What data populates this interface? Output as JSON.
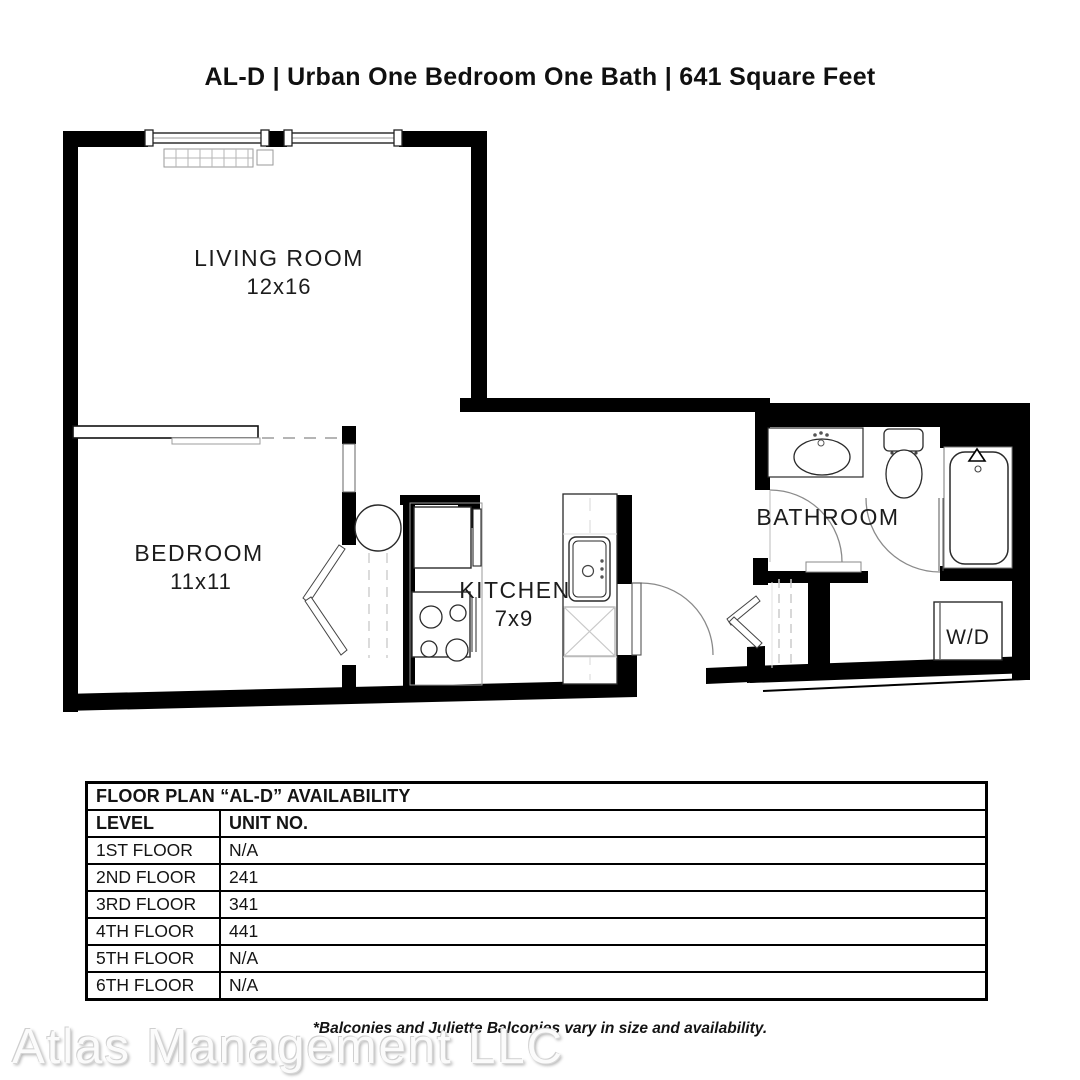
{
  "title": "AL-D | Urban One Bedroom One Bath | 641 Square Feet",
  "floor_plan": {
    "rooms": [
      {
        "name": "LIVING ROOM",
        "dimensions": "12x16"
      },
      {
        "name": "BEDROOM",
        "dimensions": "11x11"
      },
      {
        "name": "KITCHEN",
        "dimensions": "7x9"
      },
      {
        "name": "BATHROOM",
        "dimensions": ""
      },
      {
        "name": "W/D",
        "dimensions": ""
      }
    ]
  },
  "availability_table": {
    "title": "FLOOR PLAN “AL-D” AVAILABILITY",
    "columns": {
      "level": "LEVEL",
      "unit": "UNIT NO."
    },
    "rows": [
      {
        "level": "1ST FLOOR",
        "unit": "N/A"
      },
      {
        "level": "2ND FLOOR",
        "unit": "241"
      },
      {
        "level": "3RD FLOOR",
        "unit": "341"
      },
      {
        "level": "4TH FLOOR",
        "unit": "441"
      },
      {
        "level": "5TH FLOOR",
        "unit": "N/A"
      },
      {
        "level": "6TH FLOOR",
        "unit": "N/A"
      }
    ]
  },
  "footnote": "*Balconies and Juliette Balconies vary in size and availability.",
  "watermark": "Atlas Management LLC"
}
